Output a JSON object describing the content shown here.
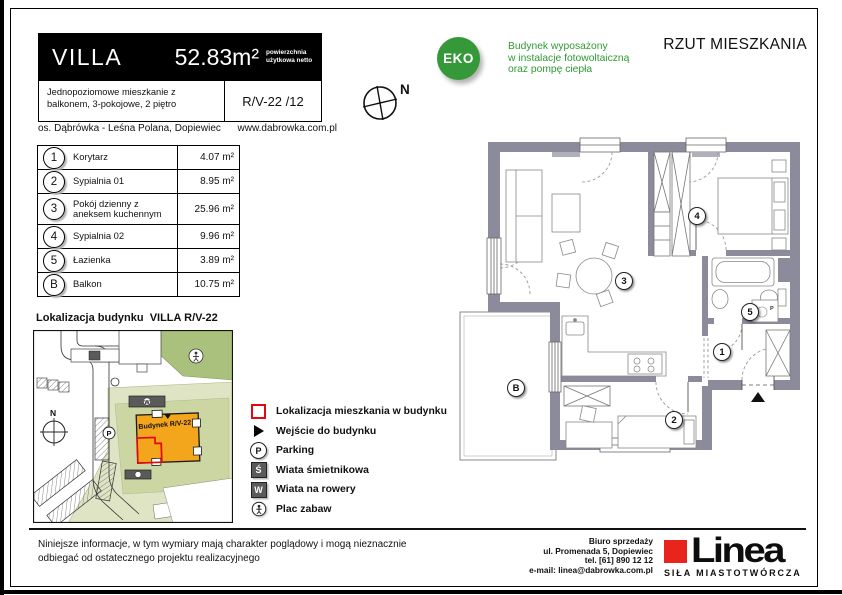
{
  "header": {
    "brand": "VILLA",
    "area_value": "52.83m²",
    "area_note": "powierzchnia użytkowa netto",
    "description": "Jednopoziomowe mieszkanie z balkonem, 3-pokojowe, 2 piętro",
    "unit_code": "R/V-22 /12",
    "location": "os. Dąbrówka - Leśna Polana, Dopiewiec",
    "website": "www.dabrowka.com.pl"
  },
  "compass": {
    "label": "N"
  },
  "eco_badge": {
    "label": "EKO",
    "line1": "Budynek wyposażony",
    "line2": "w instalacje fotowoltaiczną",
    "line3": "oraz pompę ciepła"
  },
  "page_title": "RZUT MIESZKANIA",
  "room_table": {
    "rows": [
      {
        "id": "1",
        "name": "Korytarz",
        "area": "4.07 m²"
      },
      {
        "id": "2",
        "name": "Sypialnia 01",
        "area": "8.95 m²"
      },
      {
        "id": "3",
        "name": "Pokój dzienny z aneksem kuchennym",
        "area": "25.96 m²"
      },
      {
        "id": "4",
        "name": "Sypialnia 02",
        "area": "9.96 m²"
      },
      {
        "id": "5",
        "name": "Łazienka",
        "area": "3.89 m²"
      },
      {
        "id": "B",
        "name": "Balkon",
        "area": "10.75 m²"
      }
    ]
  },
  "site_map": {
    "title": "Lokalizacja budynku  VILLA R/V-22",
    "building_label": "Budynek R/V-22",
    "compass_label": "N",
    "parking_label": "P",
    "bike_shed_label": "W"
  },
  "legend": {
    "items": [
      {
        "icon": "apartment-outline",
        "label": "Lokalizacja mieszkania w budynku"
      },
      {
        "icon": "entrance-arrow",
        "label": "Wejście do budynku"
      },
      {
        "icon": "parking-circle",
        "icon_label": "P",
        "label": "Parking"
      },
      {
        "icon": "trash-shed",
        "icon_label": "Ś",
        "label": "Wiata śmietnikowa"
      },
      {
        "icon": "bike-shed",
        "icon_label": "W",
        "label": "Wiata na rowery"
      },
      {
        "icon": "playground",
        "label": "Plac zabaw"
      }
    ]
  },
  "floor_plan": {
    "washer_label": "P"
  },
  "footer": {
    "disclaimer": "Niniejsze informacje, w tym wymiary mają charakter poglądowy i mogą nieznacznie odbiegać od ostatecznego projektu realizacyjnego",
    "office": {
      "line1": "Biuro sprzedaży",
      "line2": "ul. Promenada 5, Dopiewiec",
      "line3": "tel. [61] 890 12 12",
      "line4": "e-mail: linea@dabrowka.com.pl"
    },
    "logo_text": "Linea",
    "logo_tagline": "SIŁA MIASTOTWÓRCZA"
  },
  "colors": {
    "eco_green": "#35993a",
    "brand_red": "#e8251d",
    "building_orange": "#f3a51b",
    "apartment_red": "#e30613",
    "wall_gray": "#8b8b9b"
  }
}
